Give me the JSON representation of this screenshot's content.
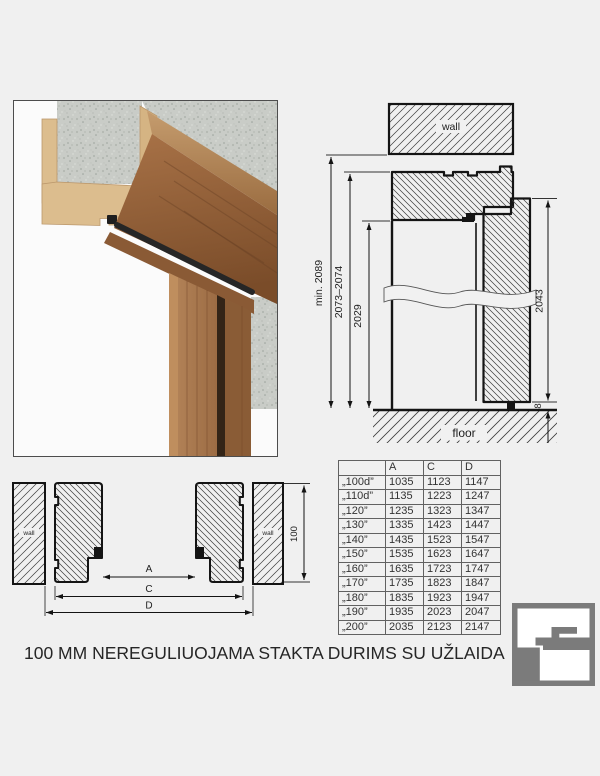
{
  "colors": {
    "background": "#f0f0f0",
    "drawing_line": "#141414",
    "logo_gray": "#7b7b7b",
    "mdf_tan": "#dcbd8e",
    "wood_brown": "#9a6b42",
    "concrete_gray": "#c9ccc7"
  },
  "vertical_section": {
    "wall_label": "wall",
    "floor_label": "floor",
    "dim_min_height": "min. 2089",
    "dim_frame_height": "2073–2074",
    "dim_opening_height": "2029",
    "dim_leaf_height": "2043",
    "dim_floor_gap": "8"
  },
  "horizontal_section": {
    "wall_left_label": "wall",
    "wall_right_label": "wall",
    "dim_depth": "100",
    "dim_a": "A",
    "dim_c": "C",
    "dim_d": "D"
  },
  "size_table": {
    "headers": [
      "",
      "A",
      "C",
      "D"
    ],
    "rows": [
      {
        "size": "„100d”",
        "a": "1035",
        "c": "1123",
        "d": "1147"
      },
      {
        "size": "„110d”",
        "a": "1135",
        "c": "1223",
        "d": "1247"
      },
      {
        "size": "„120”",
        "a": "1235",
        "c": "1323",
        "d": "1347"
      },
      {
        "size": "„130”",
        "a": "1335",
        "c": "1423",
        "d": "1447"
      },
      {
        "size": "„140”",
        "a": "1435",
        "c": "1523",
        "d": "1547"
      },
      {
        "size": "„150”",
        "a": "1535",
        "c": "1623",
        "d": "1647"
      },
      {
        "size": "„160”",
        "a": "1635",
        "c": "1723",
        "d": "1747"
      },
      {
        "size": "„170”",
        "a": "1735",
        "c": "1823",
        "d": "1847"
      },
      {
        "size": "„180”",
        "a": "1835",
        "c": "1923",
        "d": "1947"
      },
      {
        "size": "„190”",
        "a": "1935",
        "c": "2023",
        "d": "2047"
      },
      {
        "size": "„200”",
        "a": "2035",
        "c": "2123",
        "d": "2147"
      }
    ]
  },
  "caption": "100 MM NEREGULIUOJAMA STAKTA DURIMS SU UŽLAIDA",
  "logo": {
    "icon": "frame-profile-logo"
  }
}
